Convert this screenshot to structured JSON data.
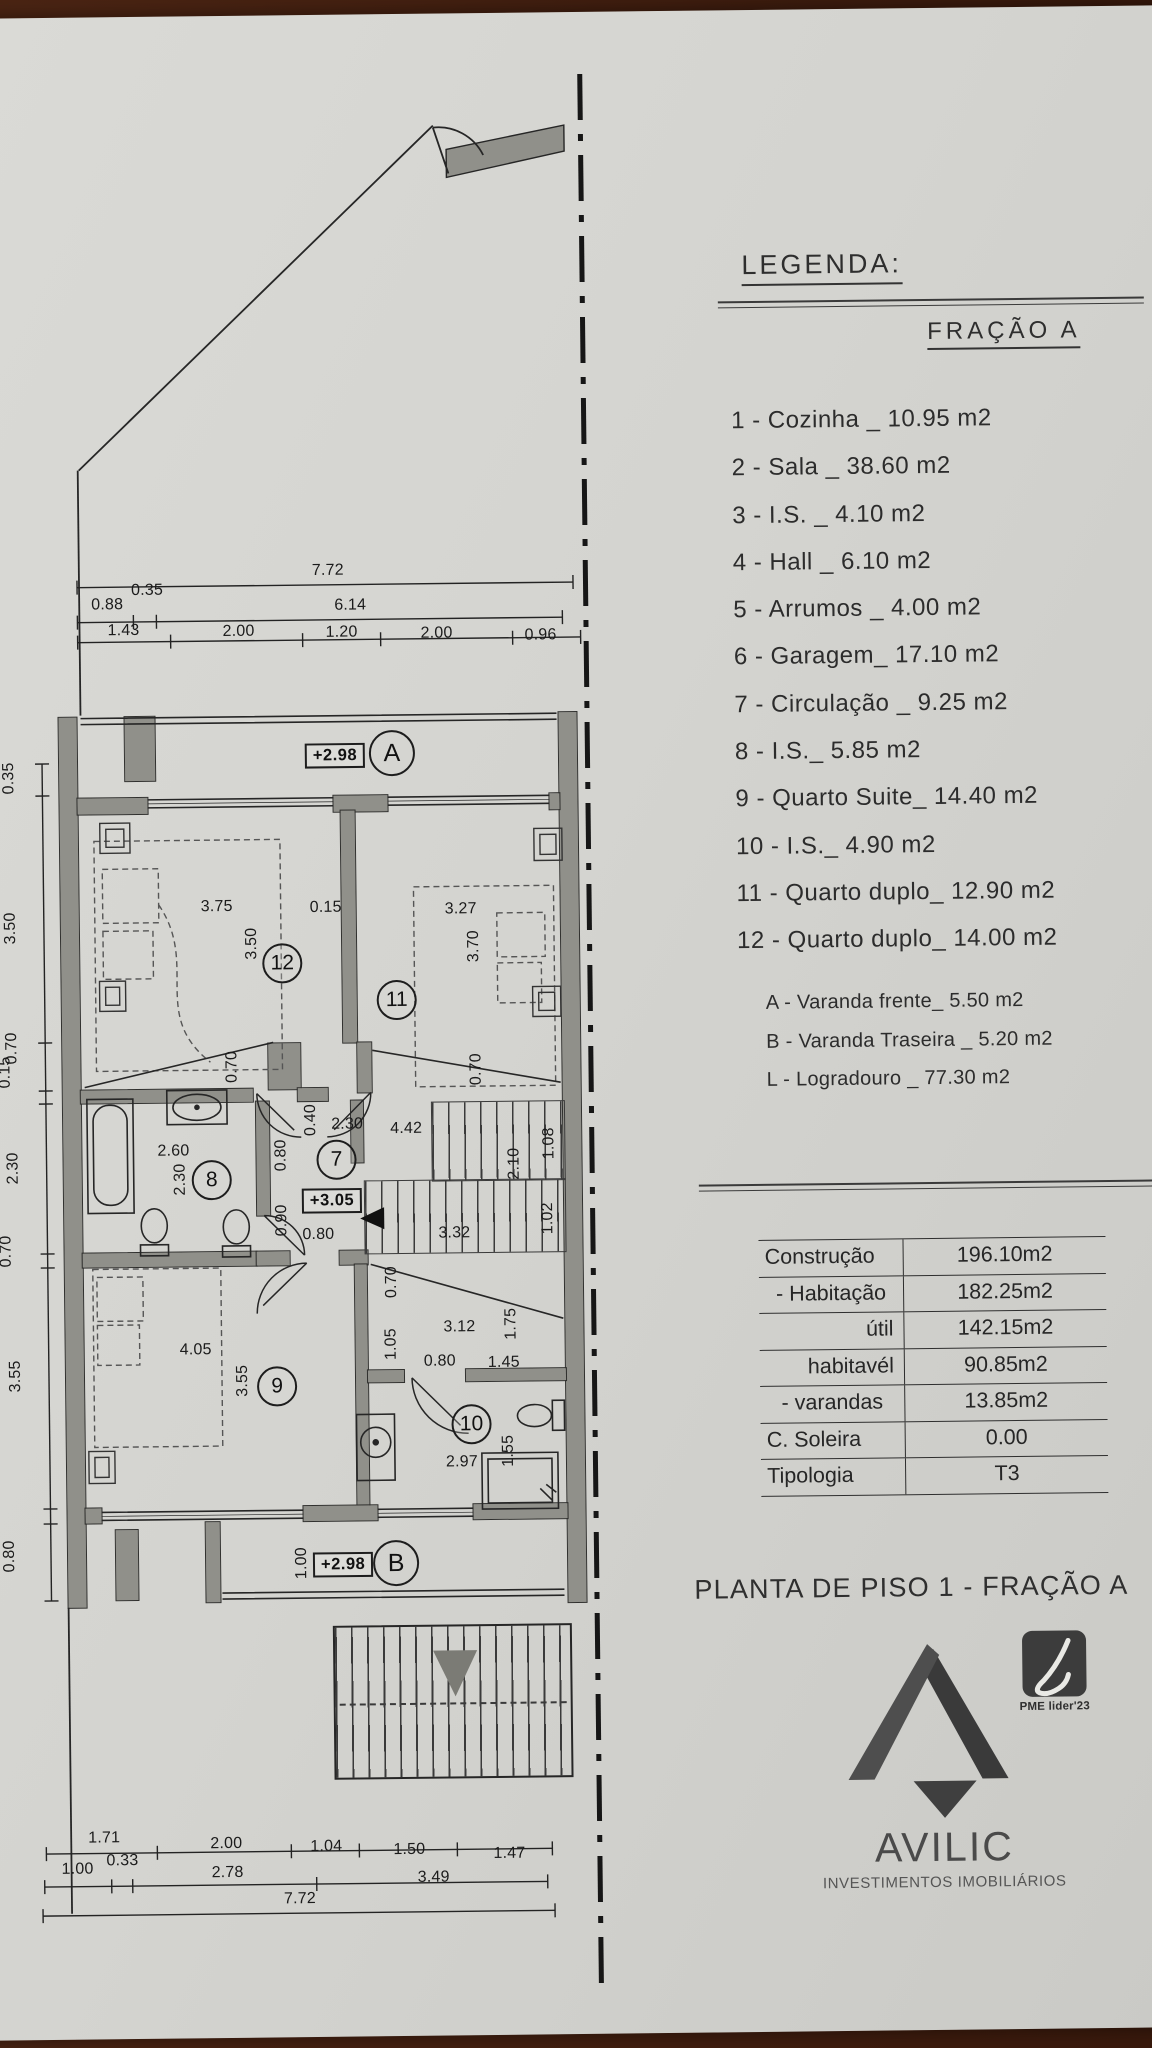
{
  "sheet": {
    "title": "PLANTA DE PISO 1 - FRAÇÃO A"
  },
  "legend": {
    "heading": "LEGENDA:",
    "fraction": "FRAÇÃO A",
    "items": [
      "1 - Cozinha _ 10.95 m2",
      "2 - Sala  _ 38.60 m2",
      "3 - I.S. _ 4.10 m2",
      "4 - Hall _ 6.10 m2",
      "5 - Arrumos _ 4.00 m2",
      "6 - Garagem_ 17.10 m2",
      "7 - Circulação _ 9.25 m2",
      "8 - I.S._ 5.85 m2",
      "9 - Quarto Suite_ 14.40 m2",
      "10 - I.S._ 4.90 m2",
      "11 - Quarto duplo_ 12.90 m2",
      "12 - Quarto duplo_ 14.00 m2"
    ],
    "annex_items": [
      "A - Varanda frente_ 5.50 m2",
      "B - Varanda Traseira _ 5.20 m2",
      "L - Logradouro _ 77.30 m2"
    ]
  },
  "areas_table": {
    "rows": [
      {
        "label": "Construção",
        "value": "196.10m2"
      },
      {
        "label": "- Habitação",
        "value": "182.25m2"
      },
      {
        "label": "útil",
        "value": "142.15m2"
      },
      {
        "label": "habitavél",
        "value": "90.85m2"
      },
      {
        "label": "- varandas",
        "value": "13.85m2"
      },
      {
        "label": "C. Soleira",
        "value": "0.00"
      },
      {
        "label": "Tipologia",
        "value": "T3"
      }
    ]
  },
  "branding": {
    "name": "AVILIC",
    "subtitle": "INVESTIMENTOS IMOBILIÁRIOS",
    "badge": "PME lider'23"
  },
  "plan": {
    "rooms": [
      {
        "n": "12",
        "x": 283,
        "y": 960
      },
      {
        "n": "11",
        "x": 397,
        "y": 998
      },
      {
        "n": "8",
        "x": 210,
        "y": 1176
      },
      {
        "n": "7",
        "x": 335,
        "y": 1157
      },
      {
        "n": "9",
        "x": 273,
        "y": 1383
      },
      {
        "n": "10",
        "x": 467,
        "y": 1423
      }
    ],
    "markers": [
      {
        "t": "A",
        "x": 395,
        "y": 751
      },
      {
        "t": "B",
        "x": 390,
        "y": 1561
      }
    ],
    "elevations": [
      {
        "t": "+2.98",
        "x": 338,
        "y": 753
      },
      {
        "t": "+3.05",
        "x": 330,
        "y": 1198
      },
      {
        "t": "+2.98",
        "x": 337,
        "y": 1562
      }
    ],
    "dim_labels": [
      {
        "t": "7.72",
        "x": 333,
        "y": 568
      },
      {
        "t": "0.88",
        "x": 112,
        "y": 600
      },
      {
        "t": "0.35",
        "x": 152,
        "y": 586
      },
      {
        "t": "6.14",
        "x": 355,
        "y": 603
      },
      {
        "t": "1.43",
        "x": 128,
        "y": 626
      },
      {
        "t": "2.00",
        "x": 243,
        "y": 628
      },
      {
        "t": "1.20",
        "x": 346,
        "y": 630
      },
      {
        "t": "2.00",
        "x": 441,
        "y": 632
      },
      {
        "t": "0.96",
        "x": 545,
        "y": 635
      },
      {
        "t": "3.75",
        "x": 218,
        "y": 903
      },
      {
        "t": "0.15",
        "x": 327,
        "y": 905
      },
      {
        "t": "3.27",
        "x": 462,
        "y": 908
      },
      {
        "t": "3.50",
        "x": 253,
        "y": 940,
        "r": -90
      },
      {
        "t": "3.70",
        "x": 475,
        "y": 945,
        "r": -90
      },
      {
        "t": "0.70",
        "x": 232,
        "y": 1063,
        "r": -90
      },
      {
        "t": "0.70",
        "x": 476,
        "y": 1068,
        "r": -90
      },
      {
        "t": "2.60",
        "x": 172,
        "y": 1147
      },
      {
        "t": "2.30",
        "x": 179,
        "y": 1175,
        "r": -90
      },
      {
        "t": "0.40",
        "x": 310,
        "y": 1117,
        "r": -90
      },
      {
        "t": "2.30",
        "x": 346,
        "y": 1122
      },
      {
        "t": "4.42",
        "x": 405,
        "y": 1127
      },
      {
        "t": "0.80",
        "x": 280,
        "y": 1152,
        "r": -90
      },
      {
        "t": "0.90",
        "x": 280,
        "y": 1217,
        "r": -90
      },
      {
        "t": "0.80",
        "x": 316,
        "y": 1232
      },
      {
        "t": "2.10",
        "x": 513,
        "y": 1163,
        "r": -90
      },
      {
        "t": "1.08",
        "x": 548,
        "y": 1143,
        "r": -90
      },
      {
        "t": "1.02",
        "x": 546,
        "y": 1218,
        "r": -90
      },
      {
        "t": "3.32",
        "x": 452,
        "y": 1232
      },
      {
        "t": "0.70",
        "x": 389,
        "y": 1280,
        "r": -90
      },
      {
        "t": "3.12",
        "x": 456,
        "y": 1326
      },
      {
        "t": "1.75",
        "x": 508,
        "y": 1323,
        "r": -90
      },
      {
        "t": "1.05",
        "x": 388,
        "y": 1342,
        "r": -90
      },
      {
        "t": "4.05",
        "x": 192,
        "y": 1346
      },
      {
        "t": "3.55",
        "x": 239,
        "y": 1377,
        "r": -90
      },
      {
        "t": "0.80",
        "x": 436,
        "y": 1360
      },
      {
        "t": "1.45",
        "x": 500,
        "y": 1362
      },
      {
        "t": "2.97",
        "x": 457,
        "y": 1461
      },
      {
        "t": "1.55",
        "x": 504,
        "y": 1450,
        "r": -90
      },
      {
        "t": "1.00",
        "x": 296,
        "y": 1560,
        "r": -90
      },
      {
        "t": "0.35",
        "x": 12,
        "y": 772,
        "r": -90
      },
      {
        "t": "3.50",
        "x": 12,
        "y": 922,
        "r": -90
      },
      {
        "t": "0.70",
        "x": 12,
        "y": 1042,
        "r": -90
      },
      {
        "t": "0.15",
        "x": 5,
        "y": 1066,
        "r": -90
      },
      {
        "t": "2.30",
        "x": 12,
        "y": 1162,
        "r": -90
      },
      {
        "t": "0.70",
        "x": 4,
        "y": 1245,
        "r": -90
      },
      {
        "t": "3.55",
        "x": 12,
        "y": 1370,
        "r": -90
      },
      {
        "t": "0.80",
        "x": 4,
        "y": 1550,
        "r": -90
      },
      {
        "t": "1.71",
        "x": 95,
        "y": 1833
      },
      {
        "t": "2.00",
        "x": 217,
        "y": 1840
      },
      {
        "t": "1.04",
        "x": 317,
        "y": 1844
      },
      {
        "t": "1.50",
        "x": 400,
        "y": 1848
      },
      {
        "t": "1.47",
        "x": 500,
        "y": 1853
      },
      {
        "t": "1.00",
        "x": 68,
        "y": 1864
      },
      {
        "t": "0.33",
        "x": 113,
        "y": 1856
      },
      {
        "t": "2.78",
        "x": 218,
        "y": 1869
      },
      {
        "t": "3.49",
        "x": 424,
        "y": 1876
      },
      {
        "t": "7.72",
        "x": 290,
        "y": 1896
      }
    ]
  }
}
